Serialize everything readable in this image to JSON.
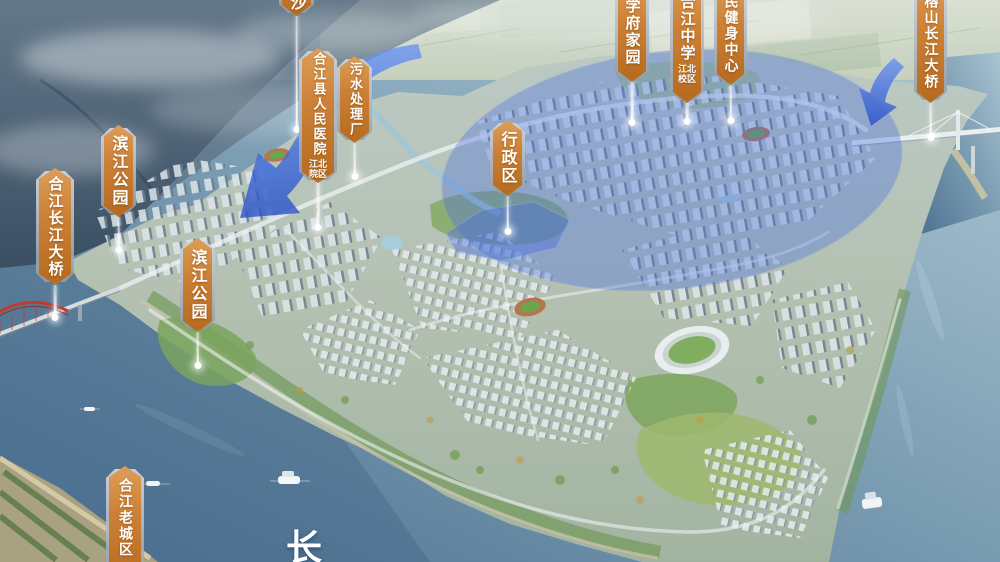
{
  "map": {
    "river_char": "长",
    "labels": {
      "sha": {
        "text": "沙"
      },
      "hejiang_bridge": {
        "text": "合江长江大桥"
      },
      "binjiang_park_1": {
        "text": "滨江公园"
      },
      "hospital": {
        "text": "合江县人民医院",
        "sub1": "江北",
        "sub2": "院区"
      },
      "sewage_plant": {
        "text": "污水处理厂"
      },
      "binjiang_park_2": {
        "text": "滨江公园"
      },
      "admin_district": {
        "text": "行政区"
      },
      "xuefu_homeland": {
        "text": "学府家园"
      },
      "middle_school": {
        "text": "合江中学",
        "sub1": "江北",
        "sub2": "校区"
      },
      "fitness_center": {
        "text": "民健身中心"
      },
      "rongshan_bridge": {
        "text": "榕山长江大桥"
      },
      "old_town": {
        "text": "合江老城区"
      }
    },
    "colors": {
      "banner_orange": "#cd8136",
      "banner_plate": "#aab3ba",
      "highlight_blue": "#4a6fdf",
      "water_deep": "#5d7f9c",
      "water_light": "#a9c4d2",
      "arch_bridge_red": "#c23a2c"
    }
  }
}
